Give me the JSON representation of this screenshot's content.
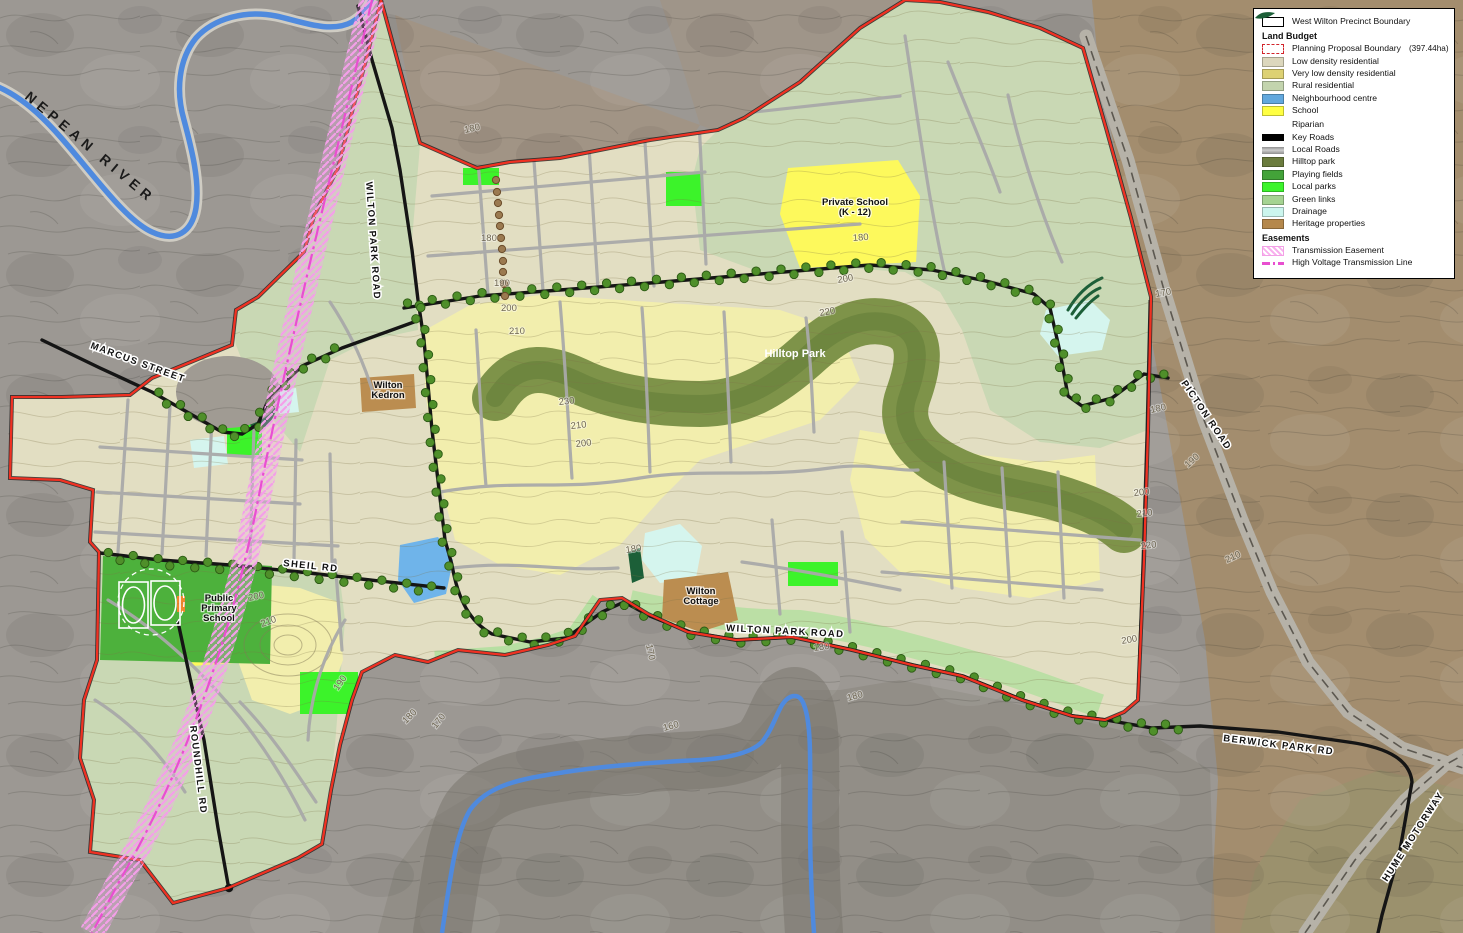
{
  "colors": {
    "outside-gray": "#9c9893",
    "outside-brown": "#a48c6a",
    "outside-tan": "#a5917a",
    "low-density": "#e2dec2",
    "very-low-density": "#f2eead",
    "rural": "#c9d8b4",
    "green-link": "#b7dfa2",
    "hilltop": "#7e9349",
    "hilltop-shade": "#5d7a35",
    "playing-fields": "#4db13c",
    "local-park": "#3cf32a",
    "school": "#fdf95c",
    "neighbourhood": "#6fb4ea",
    "drainage": "#d5f5ee",
    "heritage": "#bb8d50",
    "riparian": "#1c5f38",
    "boundary-red": "#f03122",
    "pink-hatch": "#f49fe9",
    "pink-line": "#e84fd0",
    "road-local": "#a9a9a9",
    "road-key": "#151515",
    "tree": "#4f8f2a",
    "river": "#4f8ade"
  },
  "legend": {
    "rows": [
      {
        "type": "item",
        "swatch": "outline-black",
        "label": "West Wilton Precinct Boundary"
      },
      {
        "type": "heading",
        "label": "Land Budget"
      },
      {
        "type": "item",
        "swatch": "dash-red",
        "label": "Planning Proposal Boundary",
        "value": "(397.44ha)"
      },
      {
        "type": "item",
        "swatch": "fill",
        "color": "#dcd7bd",
        "label": "Low density residential"
      },
      {
        "type": "item",
        "swatch": "fill",
        "color": "#ddd173",
        "label": "Very low density residential"
      },
      {
        "type": "item",
        "swatch": "fill",
        "color": "#c3d4ae",
        "label": "Rural residential"
      },
      {
        "type": "item",
        "swatch": "fill",
        "color": "#62a8dd",
        "label": "Neighbourhood centre"
      },
      {
        "type": "item",
        "swatch": "fill",
        "color": "#ffff42",
        "label": "School"
      },
      {
        "type": "item",
        "swatch": "riparian",
        "color": "#1c5f38",
        "label": "Riparian"
      },
      {
        "type": "item",
        "swatch": "bar-black",
        "label": "Key Roads"
      },
      {
        "type": "item",
        "swatch": "bar-gray",
        "label": "Local Roads"
      },
      {
        "type": "item",
        "swatch": "fill",
        "color": "#6b7c3e",
        "label": "Hilltop park"
      },
      {
        "type": "item",
        "swatch": "fill",
        "color": "#43a339",
        "label": "Playing fields"
      },
      {
        "type": "item",
        "swatch": "fill",
        "color": "#3cf42c",
        "label": "Local parks"
      },
      {
        "type": "item",
        "swatch": "fill",
        "color": "#a5d392",
        "label": "Green links"
      },
      {
        "type": "item",
        "swatch": "fill",
        "color": "#ccf6ee",
        "label": "Drainage"
      },
      {
        "type": "item",
        "swatch": "fill",
        "color": "#b5884c",
        "label": "Heritage properties"
      },
      {
        "type": "heading",
        "label": "Easements"
      },
      {
        "type": "item",
        "swatch": "hatch-pink",
        "label": "Transmission Easement"
      },
      {
        "type": "item",
        "swatch": "line-pink",
        "label": "High Voltage Transmission Line"
      }
    ]
  },
  "map": {
    "labels": [
      {
        "text": "NEPEAN RIVER",
        "x": 24,
        "y": 98,
        "r": 40,
        "style": "river",
        "name": "nepean-river-label"
      },
      {
        "text": "MARCUS STREET",
        "x": 90,
        "y": 348,
        "r": 20,
        "style": "road",
        "name": "marcus-street-label"
      },
      {
        "text": "WILTON PARK ROAD",
        "x": 366,
        "y": 182,
        "r": 86,
        "style": "road",
        "name": "wilton-park-road-label-north"
      },
      {
        "text": "SHEIL RD",
        "x": 283,
        "y": 566,
        "r": 6,
        "style": "road",
        "name": "sheil-rd-label"
      },
      {
        "text": "WILTON PARK ROAD",
        "x": 726,
        "y": 631,
        "r": 3,
        "style": "road",
        "name": "wilton-park-road-label-south"
      },
      {
        "text": "ROUNDHILL RD",
        "x": 190,
        "y": 726,
        "r": 83,
        "style": "road",
        "name": "roundhill-rd-label"
      },
      {
        "text": "PICTON ROAD",
        "x": 1181,
        "y": 383,
        "r": 56,
        "style": "road",
        "name": "picton-road-label"
      },
      {
        "text": "BERWICK PARK RD",
        "x": 1223,
        "y": 741,
        "r": 7,
        "style": "road",
        "name": "berwick-park-rd-label"
      },
      {
        "text": "HUME MOTORWAY",
        "x": 1387,
        "y": 882,
        "r": -57,
        "style": "road",
        "name": "hume-motorway-label"
      },
      {
        "text": "Hilltop Park",
        "x": 795,
        "y": 357,
        "r": 0,
        "style": "placeWhite",
        "name": "hilltop-park-label"
      },
      {
        "lines": [
          "Private School",
          "(K - 12)"
        ],
        "x": 855,
        "y": 205,
        "r": 0,
        "style": "place",
        "name": "private-school-label"
      },
      {
        "lines": [
          "Wilton",
          "Kedron"
        ],
        "x": 388,
        "y": 388,
        "r": 0,
        "style": "place",
        "name": "wilton-kedron-label"
      },
      {
        "lines": [
          "Wilton",
          "Cottage"
        ],
        "x": 701,
        "y": 594,
        "r": 0,
        "style": "place",
        "name": "wilton-cottage-label"
      },
      {
        "lines": [
          "Public",
          "Primary",
          "School"
        ],
        "x": 219,
        "y": 601,
        "r": 0,
        "style": "place",
        "name": "public-primary-school-label"
      },
      {
        "text": "180",
        "x": 465,
        "y": 133,
        "r": -12,
        "style": "contour",
        "name": "contour-label"
      },
      {
        "text": "180",
        "x": 481,
        "y": 241,
        "r": 0,
        "style": "contour",
        "name": "contour-label"
      },
      {
        "text": "190",
        "x": 494,
        "y": 286,
        "r": 0,
        "style": "contour",
        "name": "contour-label"
      },
      {
        "text": "200",
        "x": 501,
        "y": 311,
        "r": 0,
        "style": "contour",
        "name": "contour-label"
      },
      {
        "text": "210",
        "x": 509,
        "y": 334,
        "r": 0,
        "style": "contour",
        "name": "contour-label"
      },
      {
        "text": "230",
        "x": 559,
        "y": 405,
        "r": -6,
        "style": "contour",
        "name": "contour-label"
      },
      {
        "text": "210",
        "x": 571,
        "y": 429,
        "r": -6,
        "style": "contour",
        "name": "contour-label"
      },
      {
        "text": "200",
        "x": 576,
        "y": 447,
        "r": -6,
        "style": "contour",
        "name": "contour-label"
      },
      {
        "text": "220",
        "x": 820,
        "y": 316,
        "r": -10,
        "style": "contour",
        "name": "contour-label"
      },
      {
        "text": "200",
        "x": 838,
        "y": 283,
        "r": -10,
        "style": "contour",
        "name": "contour-label"
      },
      {
        "text": "180",
        "x": 853,
        "y": 241,
        "r": -4,
        "style": "contour",
        "name": "contour-label"
      },
      {
        "text": "180",
        "x": 626,
        "y": 553,
        "r": -8,
        "style": "contour",
        "name": "contour-label"
      },
      {
        "text": "170",
        "x": 646,
        "y": 645,
        "r": 78,
        "style": "contour",
        "name": "contour-label"
      },
      {
        "text": "180",
        "x": 814,
        "y": 651,
        "r": -8,
        "style": "contour",
        "name": "contour-label"
      },
      {
        "text": "200",
        "x": 249,
        "y": 601,
        "r": -12,
        "style": "contour",
        "name": "contour-label"
      },
      {
        "text": "210",
        "x": 262,
        "y": 627,
        "r": -20,
        "style": "contour",
        "name": "contour-label"
      },
      {
        "text": "190",
        "x": 338,
        "y": 691,
        "r": -55,
        "style": "contour",
        "name": "contour-label"
      },
      {
        "text": "180",
        "x": 406,
        "y": 724,
        "r": -45,
        "style": "contour",
        "name": "contour-label"
      },
      {
        "text": "170",
        "x": 436,
        "y": 729,
        "r": -52,
        "style": "contour",
        "name": "contour-label"
      },
      {
        "text": "160",
        "x": 664,
        "y": 731,
        "r": -15,
        "style": "contour",
        "name": "contour-label"
      },
      {
        "text": "180",
        "x": 848,
        "y": 701,
        "r": -15,
        "style": "contour",
        "name": "contour-label"
      },
      {
        "text": "170",
        "x": 1156,
        "y": 297,
        "r": -10,
        "style": "contour",
        "name": "contour-label"
      },
      {
        "text": "180",
        "x": 1151,
        "y": 413,
        "r": -12,
        "style": "contour",
        "name": "contour-label"
      },
      {
        "text": "190",
        "x": 1188,
        "y": 468,
        "r": -42,
        "style": "contour",
        "name": "contour-label"
      },
      {
        "text": "200",
        "x": 1134,
        "y": 496,
        "r": -6,
        "style": "contour",
        "name": "contour-label"
      },
      {
        "text": "210",
        "x": 1137,
        "y": 517,
        "r": -6,
        "style": "contour",
        "name": "contour-label"
      },
      {
        "text": "220",
        "x": 1141,
        "y": 549,
        "r": -6,
        "style": "contour",
        "name": "contour-label"
      },
      {
        "text": "210",
        "x": 1227,
        "y": 563,
        "r": -25,
        "style": "contour",
        "name": "contour-label"
      },
      {
        "text": "200",
        "x": 1122,
        "y": 644,
        "r": -10,
        "style": "contour",
        "name": "contour-label"
      }
    ]
  }
}
